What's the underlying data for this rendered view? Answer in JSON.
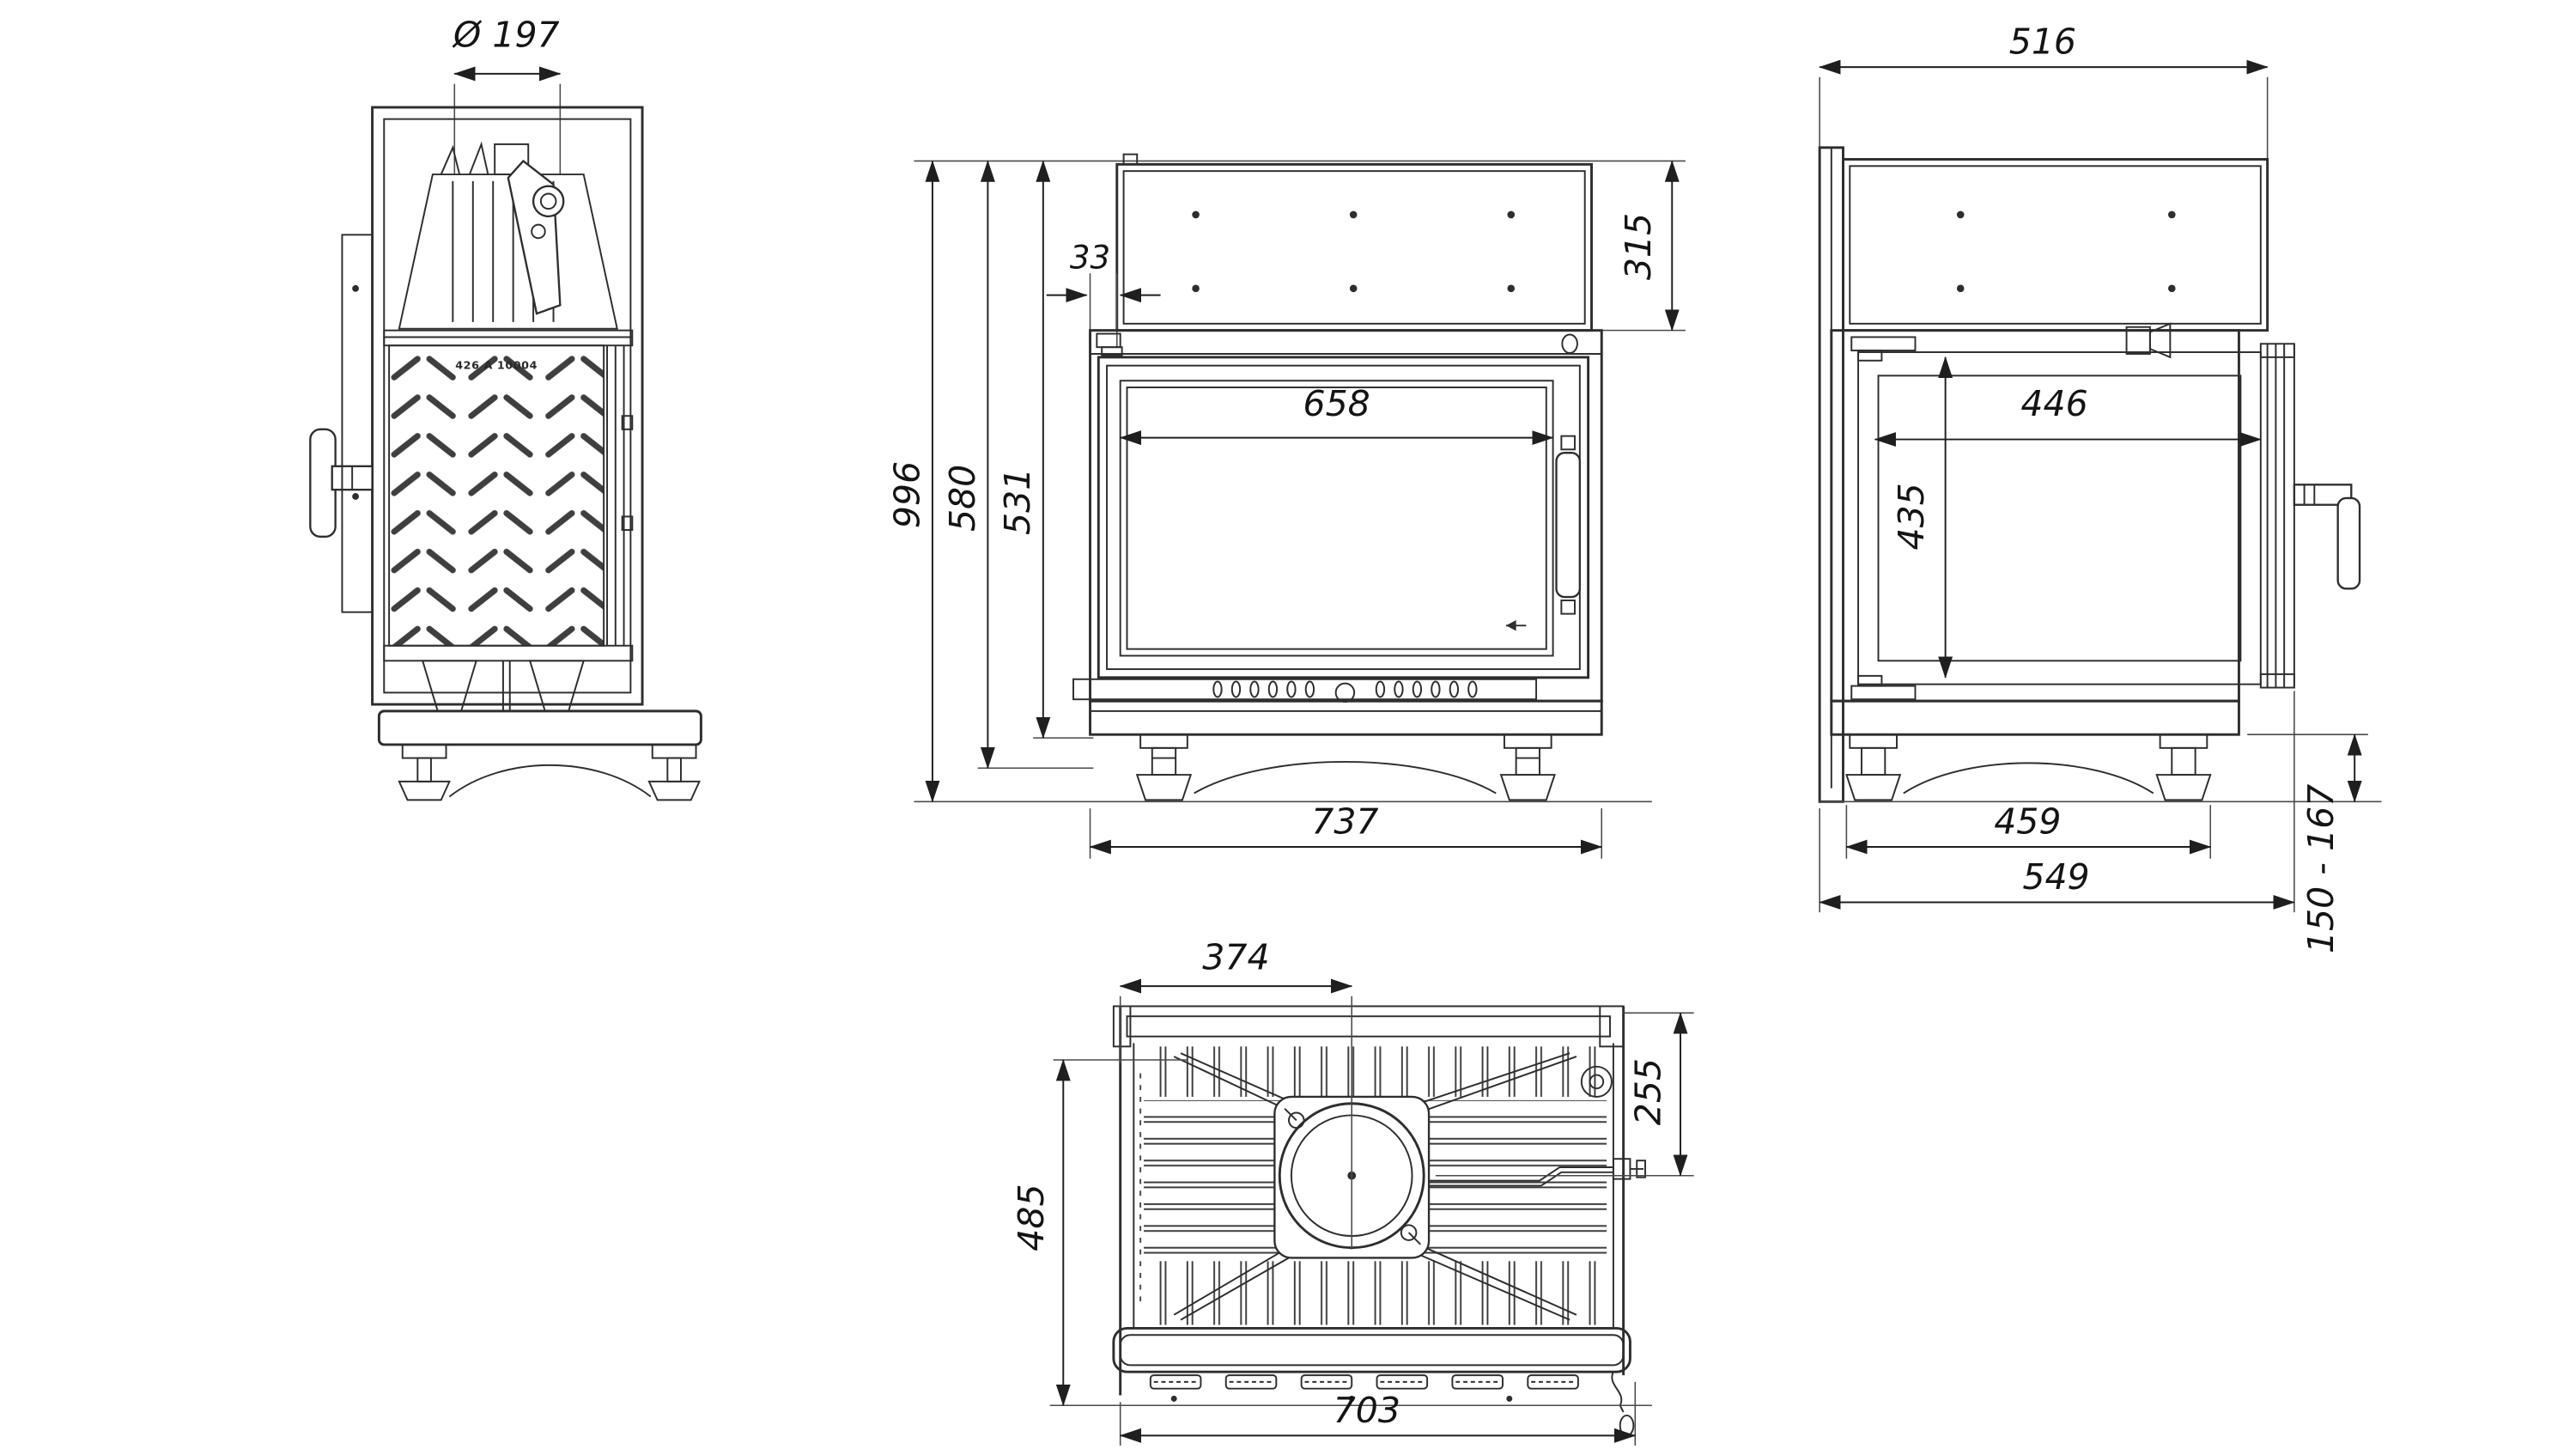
{
  "colors": {
    "background": "#ffffff",
    "ink": "#2e2e2e"
  },
  "views": {
    "side": {
      "part_number": "426 A 10004",
      "dims": {
        "flue_diameter": "Ø 197"
      }
    },
    "front": {
      "dims": {
        "overall_height": "996",
        "casing_height": "580",
        "firebox_height": "531",
        "panel_offset": "33",
        "panel_height": "315",
        "glass_width": "658",
        "overall_width": "737"
      }
    },
    "right": {
      "dims": {
        "panel_depth": "516",
        "glass_depth": "446",
        "door_height": "435",
        "feet_span": "459",
        "overall_depth": "549",
        "foot_height_range": "150 - 167"
      }
    },
    "top": {
      "dims": {
        "flue_from_left": "374",
        "flue_from_back": "255",
        "body_depth": "485",
        "front_width": "703"
      }
    }
  }
}
